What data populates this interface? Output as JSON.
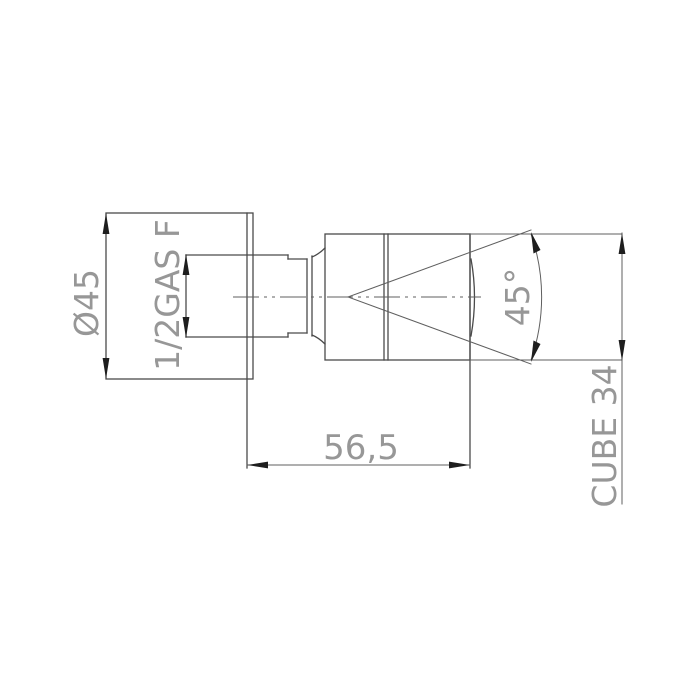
{
  "drawing": {
    "kind": "technical-dimension-drawing",
    "labels": {
      "diameter": "Ø45",
      "thread": "1/2GAS F",
      "length": "56,5",
      "angle": "45°",
      "cube": "CUBE 34"
    },
    "colors": {
      "line": "#4a4a4a",
      "thin_line": "#5f5f5f",
      "arrow": "#1e1e1e",
      "text": "#979797",
      "background": "#ffffff"
    }
  }
}
